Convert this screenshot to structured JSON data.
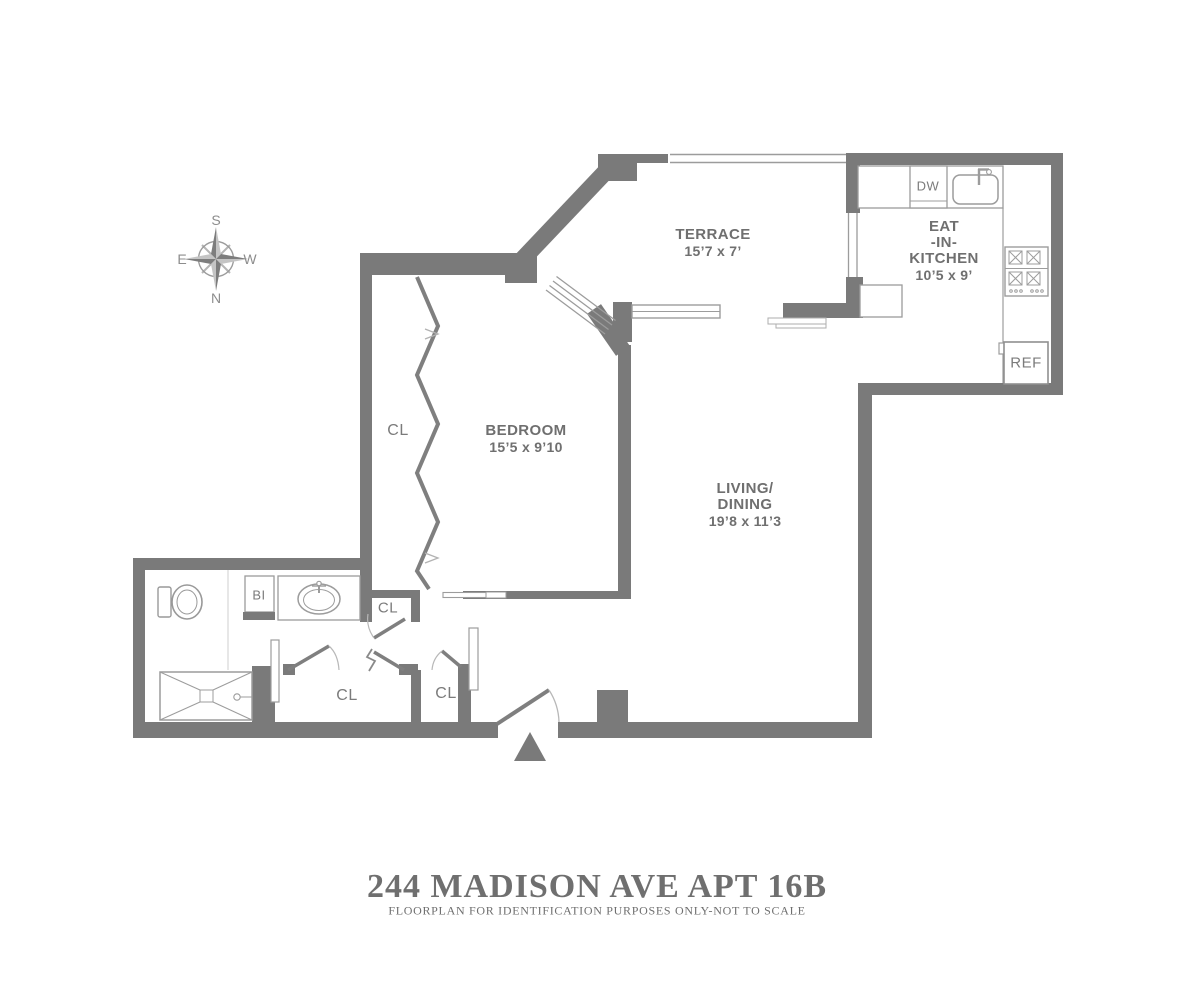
{
  "title": {
    "main": "244 MADISON AVE APT 16B",
    "disclaimer": "FLOORPLAN FOR IDENTIFICATION PURPOSES ONLY-NOT TO SCALE"
  },
  "compass": {
    "top": "S",
    "bottom": "N",
    "left": "E",
    "right": "W"
  },
  "rooms": {
    "terrace": {
      "name": "TERRACE",
      "dims": "15’7 x 7’"
    },
    "kitchen": {
      "line1": "EAT",
      "line2": "-IN-",
      "line3": "KITCHEN",
      "dims": "10’5 x 9’"
    },
    "bedroom": {
      "name": "BEDROOM",
      "dims": "15’5 x 9’10"
    },
    "living": {
      "line1": "LIVING/",
      "line2": "DINING",
      "dims": "19’8 x 11’3"
    }
  },
  "fixtures": {
    "dishwasher": "DW",
    "refrigerator": "REF",
    "built_in": "BI",
    "closet_bedroom": "CL",
    "closet_hall": "CL",
    "closet_foyer_left": "CL",
    "closet_foyer_right": "CL"
  },
  "colors": {
    "wall": "#7a7a7a",
    "fixture_line": "#9c9c9c",
    "label_text": "#6f6f6f"
  }
}
